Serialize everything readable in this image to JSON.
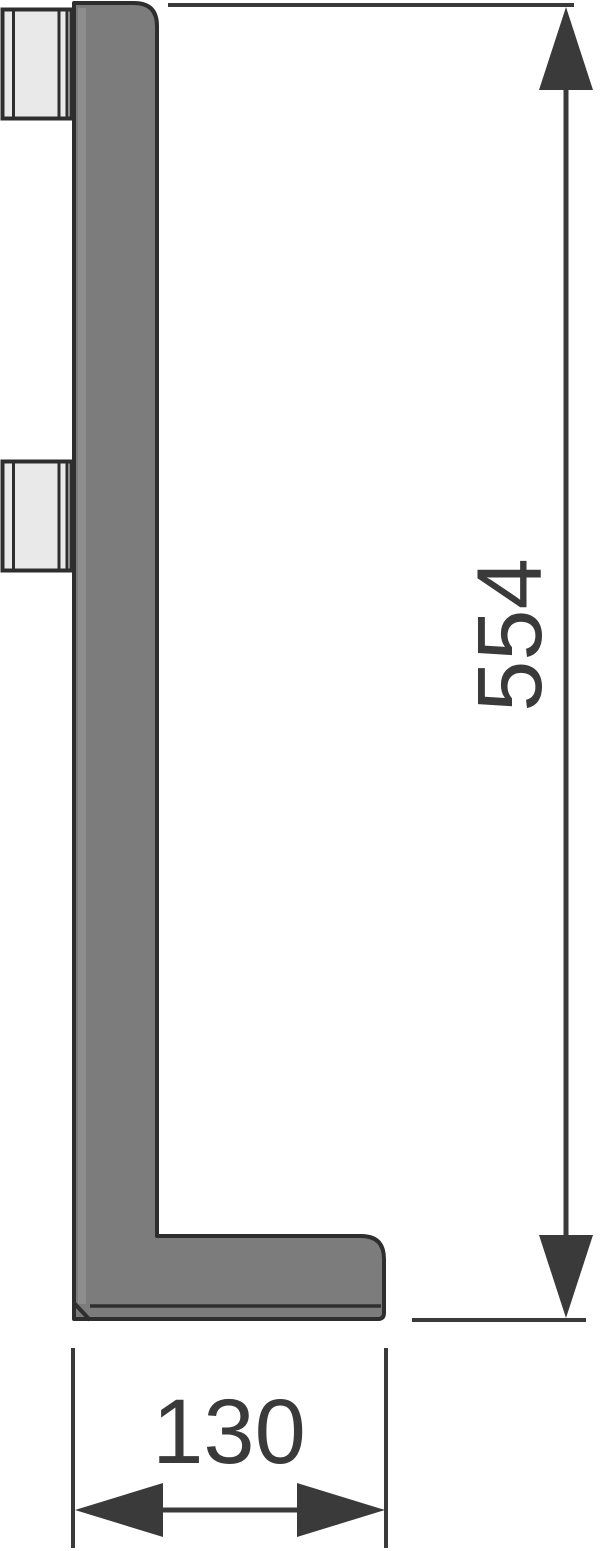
{
  "drawing": {
    "kind": "technical-cross-section",
    "subject": "L-shaped profile with two mounting clips"
  },
  "dimensions": {
    "height": {
      "label": "554"
    },
    "width": {
      "label": "130"
    }
  },
  "colors": {
    "background": "#ffffff",
    "outline": "#2e2e2e",
    "profile_fill": "#7c7c7c",
    "profile_highlight": "#8d8d8d",
    "clip_fill": "#e9e9e9",
    "dimension": "#3a3a3a",
    "label_text": "#3a3a3a"
  }
}
